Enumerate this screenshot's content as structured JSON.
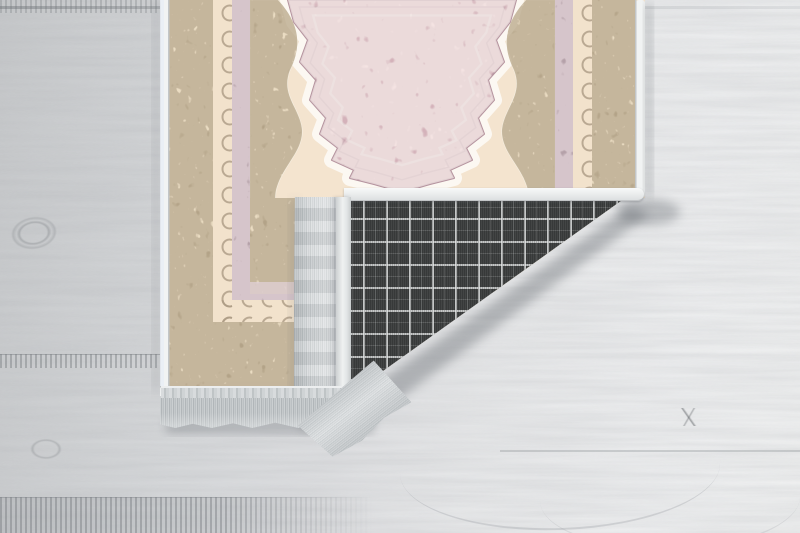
{
  "scene": {
    "type": "product-photo",
    "subject": "digitally printed runner rug with the bottom-right corner folded over, exposing a dark woven plaid non-slip backing and silvery fringe tassels, lying on a whitewashed grey wooden plank floor",
    "objects": [
      "wood-floor",
      "rug-face",
      "pink-center-medallion",
      "beige-ornate-borders",
      "mauve-guard-stripes",
      "folded-corner-flap",
      "plaid-backing",
      "edge-binding",
      "flap-fringe",
      "bottom-fringe",
      "soft-shadows"
    ]
  },
  "colors": {
    "floor-left": "#c7c9cb",
    "floor-mid": "#e0e1e3",
    "floor-right": "#f0f1f2",
    "rug-cream": "#f4e4cf",
    "rug-halo": "#fcf8f2",
    "rug-beige": "#c7b79b",
    "rug-beige-dark": "#a08f77",
    "rug-speckle": "#f0e3c9",
    "guard-cream": "#f2e2cc",
    "crescent": "#ac9b84",
    "mauve": "#b5a1a9",
    "mauve-speckle": "#e2d2d7",
    "pink": "#eac7cc",
    "pink-dark": "#b5939e",
    "binding": "#f1f3f3",
    "binding-shade": "#c2c6c8",
    "plaid-base": "#434545",
    "plaid-line": "#dcdfdf",
    "plaid-line-faint": "#9b9f9f",
    "fringe": "#ced2d4",
    "fringe-shade": "#aab0b3",
    "selvage": "#eff1f1",
    "shadow": "#4f555b"
  }
}
